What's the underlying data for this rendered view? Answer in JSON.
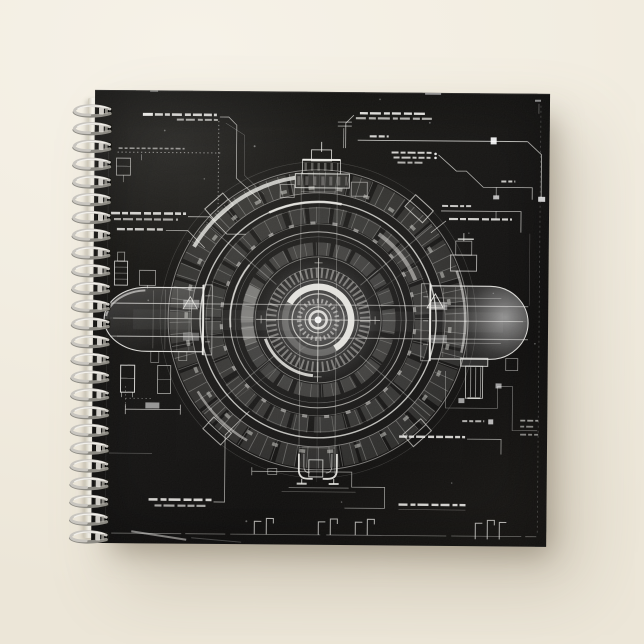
{
  "scene": {
    "type": "product-photo",
    "background_top_color": "#f6f2e8",
    "background_bottom_color": "#ece6d8",
    "shadow_color": "rgba(120,108,88,0.45)"
  },
  "notebook": {
    "view": "front cover with spiral binding on left edge",
    "cover_color": "#131210",
    "page_edge_color": "#f8f6ef",
    "spiral": {
      "coil_count": 25,
      "metal_color": "#c8c5bf"
    },
    "artwork": {
      "style": "black-and-white technical blueprint of a circular machine",
      "ink_color": "#e9e8e3",
      "elements": [
        "concentric segmented ring assembly",
        "central hub with crosshair",
        "left capsule pod with warning triangle",
        "right capsule pod with glowing dome",
        "top turret stack",
        "bottom clamp assembly",
        "leader-line callouts with micro-text",
        "dotted reference lines",
        "dimension lines",
        "bottom bracket tick marks"
      ]
    }
  }
}
